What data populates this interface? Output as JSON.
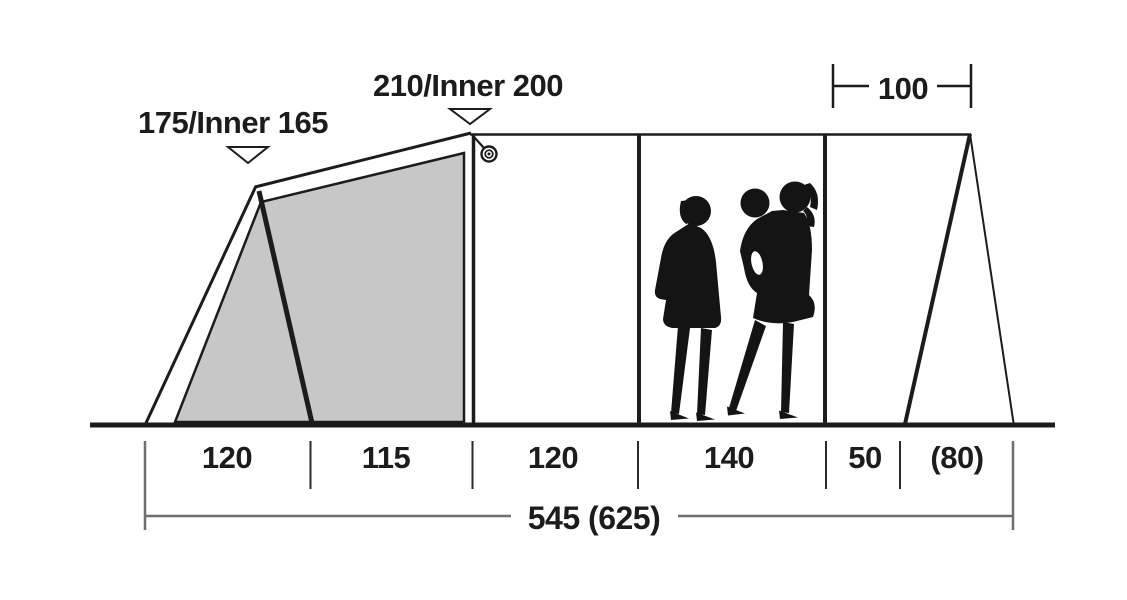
{
  "diagram": {
    "type": "tent-side-profile-dimensions",
    "height_labels": [
      {
        "text": "175/Inner 165"
      },
      {
        "text": "210/Inner 200"
      }
    ],
    "top_width_label": {
      "text": "100"
    },
    "section_labels": [
      {
        "text": "120"
      },
      {
        "text": "115"
      },
      {
        "text": "120"
      },
      {
        "text": "140"
      },
      {
        "text": "50"
      },
      {
        "text": "(80)"
      }
    ],
    "total_length_label": {
      "text": "545 (625)"
    },
    "colors": {
      "line": "#1c1c1c",
      "inner_tent_fill": "#c7c7c7",
      "dimension_line": "#6f6f6f",
      "silhouette": "#141414"
    }
  }
}
